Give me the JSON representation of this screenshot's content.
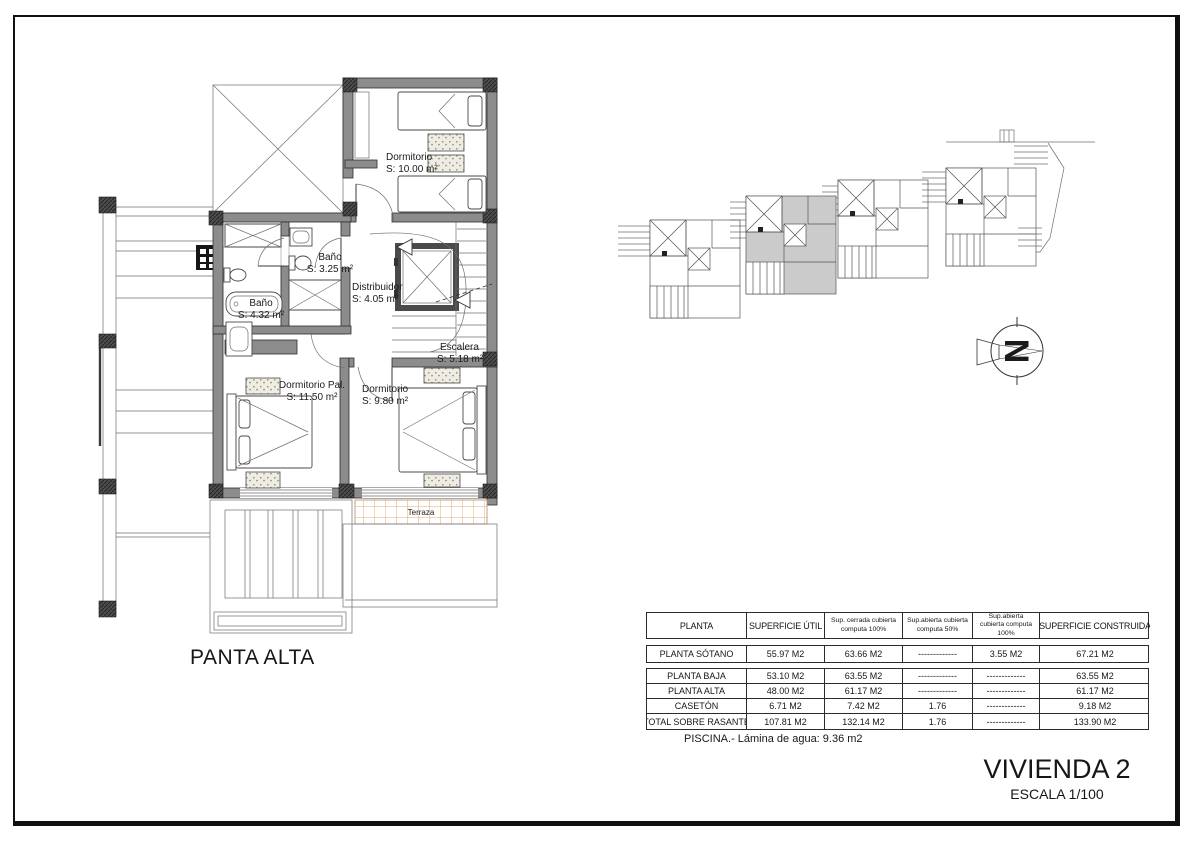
{
  "sheet": {
    "plan_title": "PANTA ALTA",
    "project_title": "VIVIENDA 2",
    "scale_label": "ESCALA 1/100",
    "pool_note": "PISCINA.- Lámina de agua: 9.36 m2"
  },
  "floor_plan": {
    "rooms": [
      {
        "name": "Dormitorio",
        "area": "S: 10.00 m²"
      },
      {
        "name": "Baño",
        "area": "S: 3.25 m²"
      },
      {
        "name": "Baño",
        "area": "S: 4.32 m²"
      },
      {
        "name": "Distribuidor",
        "area": "S: 4.05 m²"
      },
      {
        "name": "Escalera",
        "area": "S: 5.18 m²"
      },
      {
        "name": "Dormitorio Pal.",
        "area": "S: 11.50 m²"
      },
      {
        "name": "Dormitorio",
        "area": "S: 9.80 m²"
      },
      {
        "name": "Terraza",
        "area": ""
      }
    ]
  },
  "site_plan": {
    "units": 4,
    "highlighted_unit": 2
  },
  "compass": {
    "letter": "N"
  },
  "areas_table": {
    "headers": [
      "PLANTA",
      "SUPERFICIE ÚTIL",
      "Sup. cerrada cubierta computa 100%",
      "Sup.abierta cubierta computa 50%",
      "Sup.abierta cubierta computa 100%",
      "SUPERFICIE CONSTRUIDA"
    ],
    "rows": [
      {
        "cells": [
          "PLANTA SÓTANO",
          "55.97 M2",
          "63.66 M2",
          "-------------",
          "3.55 M2",
          "67.21 M2"
        ]
      },
      {
        "cells": [
          "PLANTA BAJA",
          "53.10 M2",
          "63.55 M2",
          "-------------",
          "-------------",
          "63.55 M2"
        ]
      },
      {
        "cells": [
          "PLANTA ALTA",
          "48.00 M2",
          "61.17 M2",
          "-------------",
          "-------------",
          "61.17 M2"
        ]
      },
      {
        "cells": [
          "CASETÓN",
          "6.71 M2",
          "7.42 M2",
          "1.76",
          "-------------",
          "9.18 M2"
        ]
      },
      {
        "cells": [
          "TOTAL SOBRE RASANTE",
          "107.81 M2",
          "132.14 M2",
          "1.76",
          "-------------",
          "133.90 M2"
        ]
      }
    ]
  },
  "colors": {
    "wall": "#8c8c8c",
    "column": "#474747",
    "bath_grid": "#b5c7ea",
    "terrace_grid": "#ddab78",
    "site_highlight": "#cbcbcb",
    "line": "#2f2f2f"
  }
}
